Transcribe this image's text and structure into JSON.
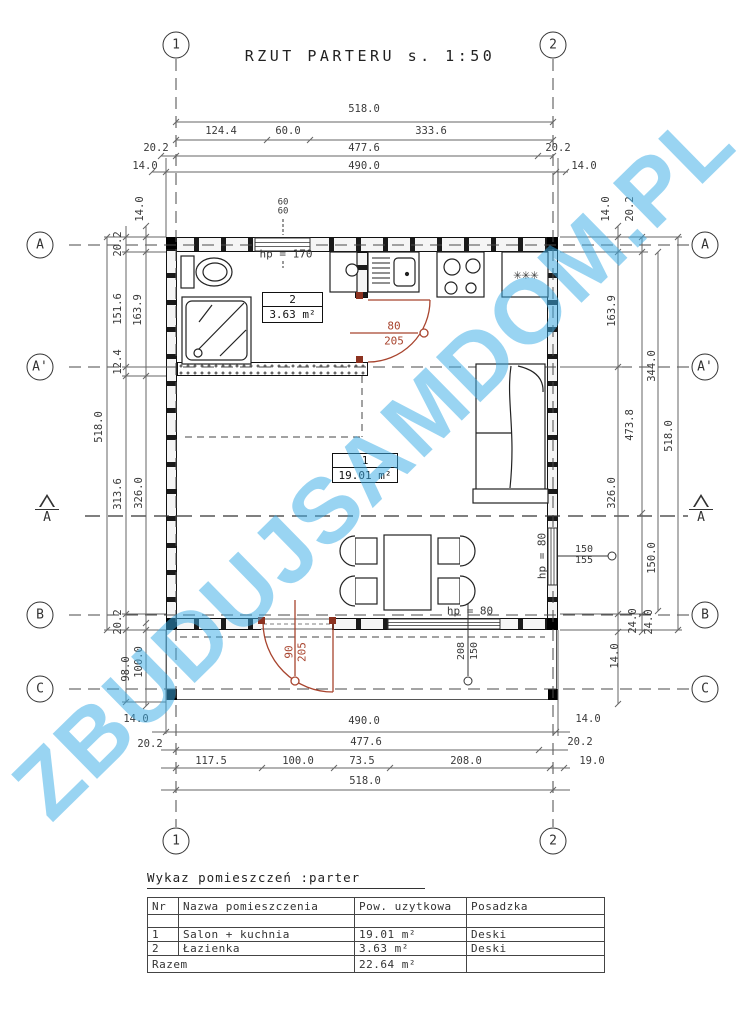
{
  "title": "RZUT PARTERU s. 1:50",
  "watermark": "ZBUDUJSAMDOM.PL",
  "grid": {
    "cols": [
      {
        "label": "1",
        "x": 176
      },
      {
        "label": "2",
        "x": 553
      }
    ],
    "rows": [
      {
        "label": "A",
        "y": 245
      },
      {
        "label": "A'",
        "y": 367
      },
      {
        "label": "B",
        "y": 615
      },
      {
        "label": "C",
        "y": 689
      }
    ],
    "section_label": "A"
  },
  "rooms": [
    {
      "nr": "1",
      "area": "19.01 m²"
    },
    {
      "nr": "2",
      "area": "3.63 m²"
    }
  ],
  "plan": {
    "labels": [
      {
        "t": "518.0",
        "x": 364,
        "y": 109
      },
      {
        "t": "124.4",
        "x": 221,
        "y": 131
      },
      {
        "t": "60.0",
        "x": 288,
        "y": 131
      },
      {
        "t": "333.6",
        "x": 431,
        "y": 131
      },
      {
        "t": "20.2",
        "x": 156,
        "y": 148
      },
      {
        "t": "477.6",
        "x": 364,
        "y": 148
      },
      {
        "t": "20.2",
        "x": 558,
        "y": 148
      },
      {
        "t": "14.0",
        "x": 145,
        "y": 166
      },
      {
        "t": "490.0",
        "x": 364,
        "y": 166
      },
      {
        "t": "14.0",
        "x": 584,
        "y": 166
      },
      {
        "t": "60",
        "x": 283,
        "y": 203,
        "s": 9
      },
      {
        "t": "60",
        "x": 283,
        "y": 212,
        "s": 9
      },
      {
        "t": "518.0",
        "x": 99,
        "y": 427,
        "r": -90
      },
      {
        "t": "20.2",
        "x": 118,
        "y": 244,
        "r": -90
      },
      {
        "t": "151.6",
        "x": 118,
        "y": 309,
        "r": -90
      },
      {
        "t": "12.4",
        "x": 118,
        "y": 362,
        "r": -90
      },
      {
        "t": "313.6",
        "x": 118,
        "y": 494,
        "r": -90
      },
      {
        "t": "20.2",
        "x": 118,
        "y": 622,
        "r": -90
      },
      {
        "t": "98.0",
        "x": 126,
        "y": 669,
        "r": -90
      },
      {
        "t": "14.0",
        "x": 140,
        "y": 209,
        "r": -90
      },
      {
        "t": "163.9",
        "x": 138,
        "y": 310,
        "r": -90
      },
      {
        "t": "326.0",
        "x": 139,
        "y": 493,
        "r": -90
      },
      {
        "t": "100.0",
        "x": 139,
        "y": 662,
        "r": -90
      },
      {
        "t": "14.0",
        "x": 136,
        "y": 719
      },
      {
        "t": "14.0",
        "x": 606,
        "y": 209,
        "r": -90
      },
      {
        "t": "20.2",
        "x": 630,
        "y": 209,
        "r": -90
      },
      {
        "t": "163.9",
        "x": 612,
        "y": 311,
        "r": -90
      },
      {
        "t": "344.0",
        "x": 652,
        "y": 366,
        "r": -90
      },
      {
        "t": "473.8",
        "x": 630,
        "y": 425,
        "r": -90
      },
      {
        "t": "518.0",
        "x": 669,
        "y": 436,
        "r": -90
      },
      {
        "t": "326.0",
        "x": 612,
        "y": 493,
        "r": -90
      },
      {
        "t": "150.0",
        "x": 652,
        "y": 558,
        "r": -90
      },
      {
        "t": "24.0",
        "x": 633,
        "y": 621,
        "r": -90
      },
      {
        "t": "24.0",
        "x": 649,
        "y": 622,
        "r": -90
      },
      {
        "t": "14.0",
        "x": 615,
        "y": 656,
        "r": -90
      },
      {
        "t": "14.0",
        "x": 588,
        "y": 719
      },
      {
        "t": "490.0",
        "x": 364,
        "y": 721
      },
      {
        "t": "477.6",
        "x": 366,
        "y": 742
      },
      {
        "t": "20.2",
        "x": 150,
        "y": 744
      },
      {
        "t": "20.2",
        "x": 580,
        "y": 742
      },
      {
        "t": "117.5",
        "x": 211,
        "y": 761
      },
      {
        "t": "100.0",
        "x": 298,
        "y": 761
      },
      {
        "t": "73.5",
        "x": 362,
        "y": 761
      },
      {
        "t": "208.0",
        "x": 466,
        "y": 761
      },
      {
        "t": "19.0",
        "x": 592,
        "y": 761
      },
      {
        "t": "518.0",
        "x": 365,
        "y": 781
      },
      {
        "t": "hp = 170",
        "x": 286,
        "y": 254,
        "s": 11
      },
      {
        "t": "hp = 80",
        "x": 470,
        "y": 611,
        "s": 11
      },
      {
        "t": "hp = 80",
        "x": 542,
        "y": 556,
        "r": -90,
        "s": 11
      },
      {
        "t": "150",
        "x": 584,
        "y": 550,
        "s": 10
      },
      {
        "t": "155",
        "x": 584,
        "y": 561,
        "s": 10
      },
      {
        "t": "208",
        "x": 462,
        "y": 651,
        "r": -90,
        "s": 10
      },
      {
        "t": "150",
        "x": 475,
        "y": 651,
        "r": -90,
        "s": 10
      },
      {
        "t": "80",
        "x": 394,
        "y": 326,
        "c": "red",
        "s": 11
      },
      {
        "t": "205",
        "x": 394,
        "y": 341,
        "c": "red",
        "s": 11
      },
      {
        "t": "90",
        "x": 289,
        "y": 652,
        "r": -90,
        "c": "red",
        "s": 11
      },
      {
        "t": "205",
        "x": 302,
        "y": 652,
        "r": -90,
        "c": "red",
        "s": 11
      },
      {
        "t": "✳✳✳",
        "x": 526,
        "y": 275,
        "s": 14
      }
    ]
  },
  "schedule": {
    "title": "Wykaz pomieszczeń :parter",
    "headers": [
      "Nr",
      "Nazwa pomieszczenia",
      "Pow. uzytkowa",
      "Posadzka"
    ],
    "rows": [
      [
        "1",
        "Salon + kuchnia",
        "19.01 m²",
        "Deski"
      ],
      [
        "2",
        "Łazienka",
        "3.63 m²",
        "Deski"
      ]
    ],
    "total_label": "Razem",
    "total_value": "22.64 m²"
  }
}
